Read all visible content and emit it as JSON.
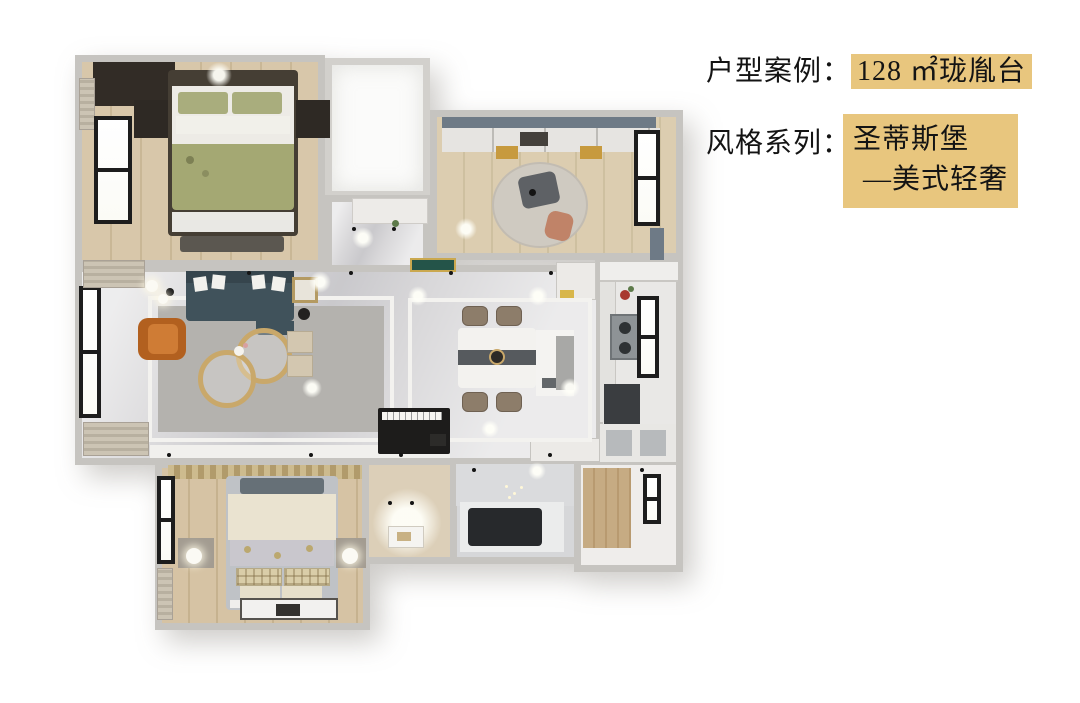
{
  "header": {
    "case_label": "户型案例：",
    "case_value": "128 ㎡珑胤台",
    "style_label": "风格系列：",
    "style_value_line1": "圣蒂斯堡",
    "style_value_line2": "—美式轻奢",
    "highlight_color": "#e8c67e",
    "text_color": "#141414"
  },
  "floorplan": {
    "colors": {
      "wall": "#c6c4c0",
      "marble_floor": "#d8d7d9",
      "wood_floor": "#d8c7aa",
      "sofa": "#40525b",
      "armchair": "#b2601f",
      "accent_gold": "#c9a86a",
      "bedding_green": "#a4a873",
      "bedding_cream": "#eae3d0",
      "piano": "#1d1c1b",
      "window_frame": "#1d1d1d",
      "bathtub": "#27292c"
    }
  }
}
